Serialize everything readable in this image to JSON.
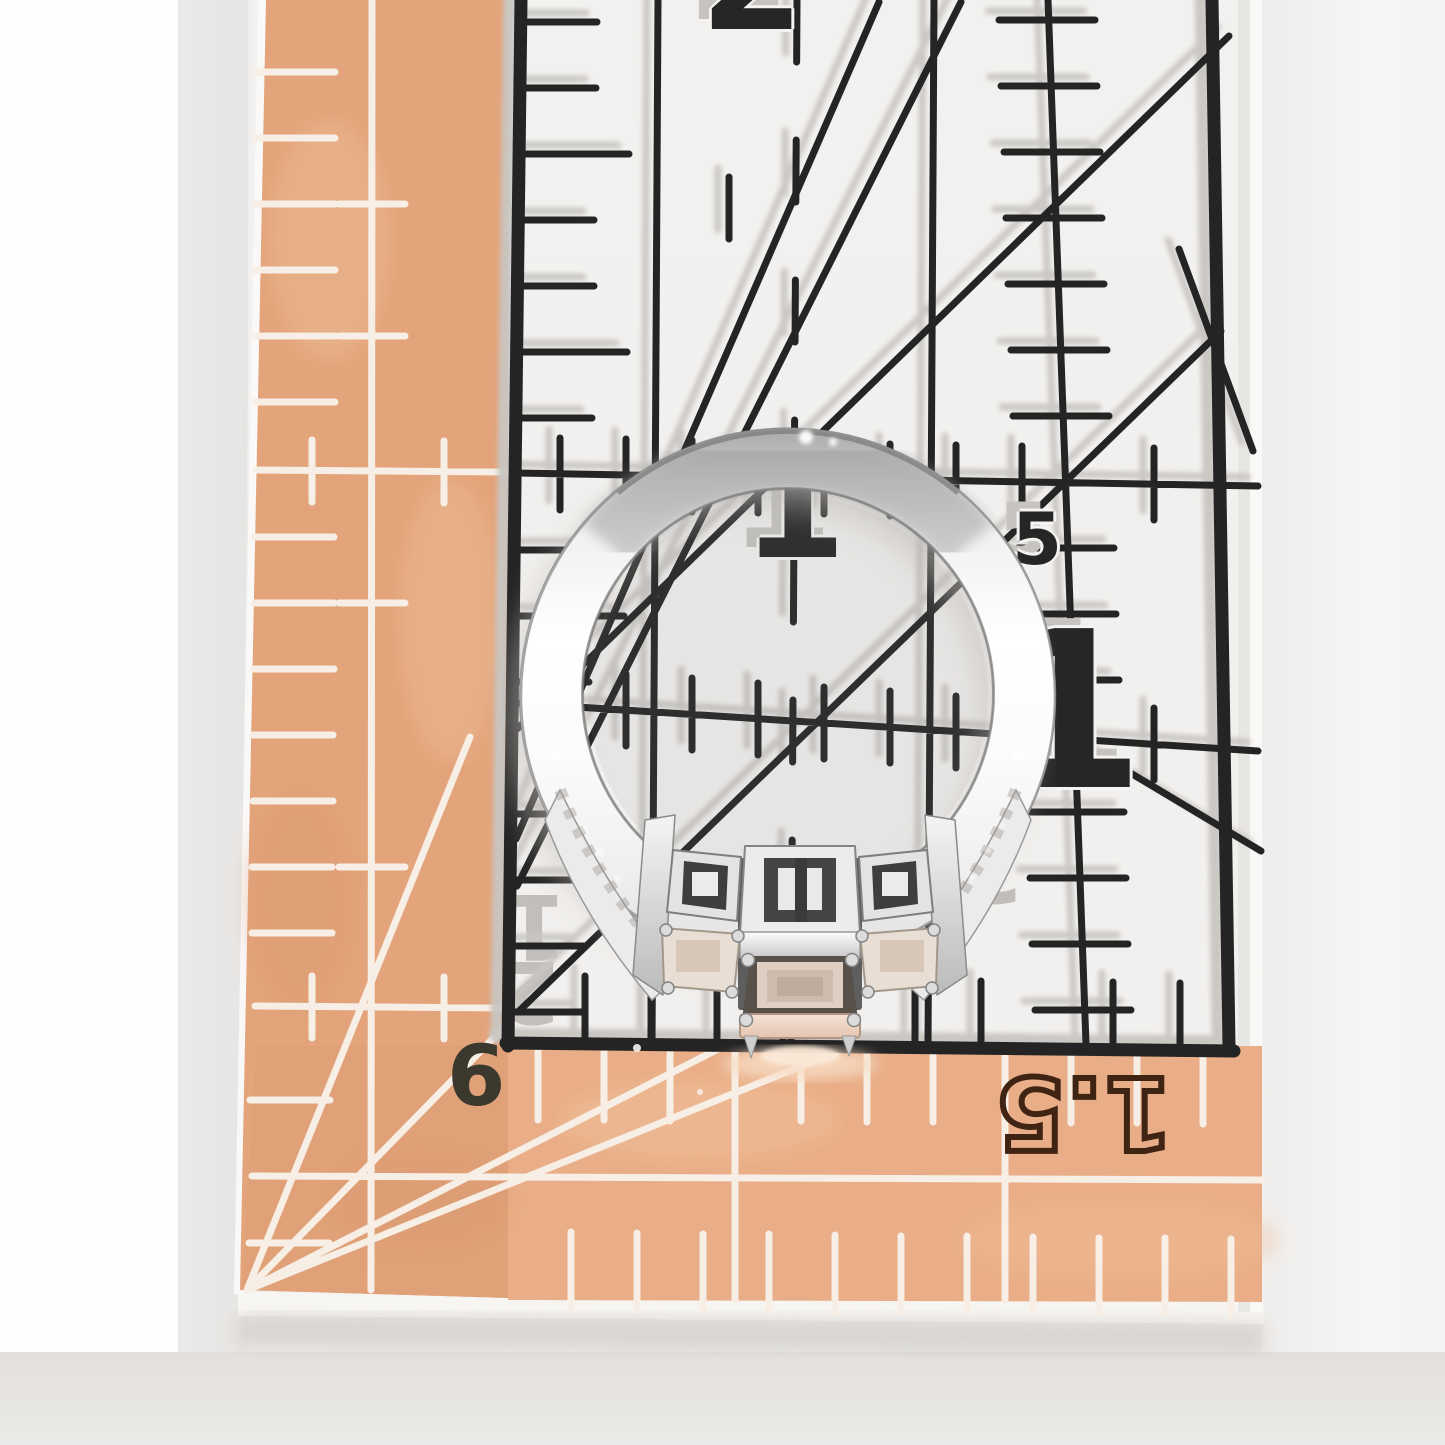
{
  "scene": {
    "alt": "Silver three-stone ring standing upright on an upside-down transparent quilting ruler with a peach grid border, photographed from the side"
  },
  "ruler": {
    "grid_numbers": {
      "two": "2",
      "one_inner": "1",
      "five": "5",
      "one_outer": "1"
    },
    "shadow_numbers": {
      "one": "1",
      "two": "2",
      "three": "3"
    },
    "border_numbers": {
      "six": "6",
      "one_point_five": "1.5"
    },
    "colors": {
      "peach_band": "#e3a47b",
      "peach_band_bottom": "#e9ae87",
      "mark_black": "#242424",
      "mark_shadow_gray": "#c9c6c2",
      "mark_white": "#f7eee5",
      "digit_outline_brown": "#3f2414"
    }
  },
  "ring": {
    "colors": {
      "metal_bright": "#ffffff",
      "metal_mid": "#d9d9d9",
      "metal_dark": "#8f8f8f",
      "center_stone": "#e7d2c3",
      "shadow": "#c5c1bd"
    }
  }
}
